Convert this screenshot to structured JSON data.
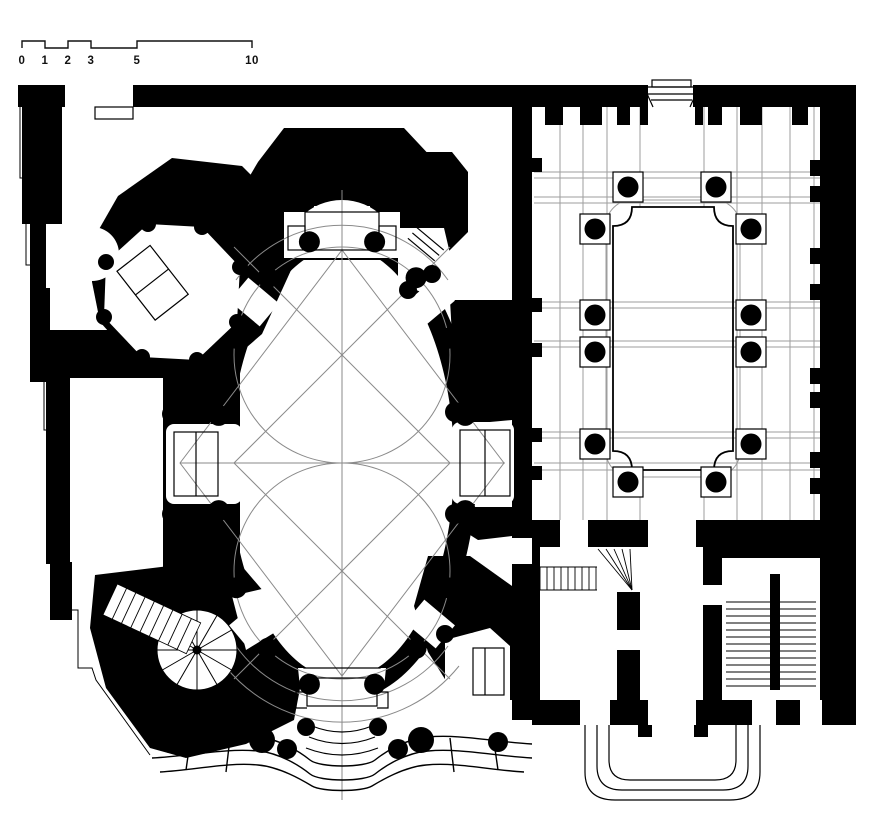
{
  "scale_bar": {
    "labels": [
      "0",
      "1",
      "2",
      "3",
      "5",
      "10"
    ],
    "tick_x": [
      22,
      45,
      68,
      91,
      137,
      252
    ],
    "top_y": 41,
    "base_y": 48,
    "label_y": 64
  },
  "colors": {
    "ink": "#000000",
    "paper": "#ffffff",
    "construction_line": "#8a8a8a",
    "paving_line": "#9d9d9d"
  },
  "church": {
    "center": [
      342,
      463
    ],
    "nave_rx": 112,
    "nave_ry": 216,
    "ring_rx": 135,
    "ring_ry": 238,
    "circle_r": 108,
    "circle_centers": [
      [
        342,
        355
      ],
      [
        342,
        571
      ]
    ],
    "rhombus": [
      [
        180,
        463
      ],
      [
        342,
        250
      ],
      [
        504,
        463
      ],
      [
        342,
        676
      ]
    ],
    "axis_x": 342,
    "column_ring": [
      126,
      229
    ],
    "column_angles_deg": [
      15,
      36,
      57,
      78
    ],
    "column_radius": 10.5,
    "chapel_dots": [
      [
        408,
        290,
        9
      ],
      [
        432,
        274,
        9
      ],
      [
        445,
        634,
        9
      ],
      [
        470,
        624,
        9
      ],
      [
        172,
        414,
        10
      ],
      [
        172,
        514,
        10
      ],
      [
        455,
        412,
        10
      ],
      [
        455,
        514,
        10
      ]
    ]
  },
  "sacristy": {
    "octagon": [
      [
        240,
        267
      ],
      [
        202,
        227
      ],
      [
        148,
        224
      ],
      [
        106,
        262
      ],
      [
        104,
        317
      ],
      [
        142,
        357
      ],
      [
        197,
        360
      ],
      [
        237,
        322
      ]
    ],
    "corner_dot_r": 8
  },
  "facade": {
    "blobs": [
      [
        262,
        740,
        13
      ],
      [
        287,
        749,
        10
      ],
      [
        398,
        749,
        10
      ],
      [
        421,
        740,
        13
      ],
      [
        306,
        727,
        9
      ],
      [
        378,
        727,
        9
      ],
      [
        170,
        744,
        9
      ],
      [
        498,
        742,
        10
      ]
    ]
  },
  "spiral_stair": {
    "cx": 197,
    "cy": 650,
    "r": 40,
    "spokes": 12,
    "hub_r": 4
  },
  "diagonal_stair": {
    "angle": 25,
    "px": 150,
    "py": 618,
    "x": 106,
    "y": 601,
    "w": 92,
    "h": 34,
    "treads": 9
  },
  "cloister": {
    "columns": [
      [
        628,
        187
      ],
      [
        716,
        187
      ],
      [
        595,
        229
      ],
      [
        751,
        229
      ],
      [
        595,
        315
      ],
      [
        751,
        315
      ],
      [
        595,
        352
      ],
      [
        751,
        352
      ],
      [
        595,
        444
      ],
      [
        751,
        444
      ],
      [
        628,
        482
      ],
      [
        716,
        482
      ]
    ],
    "column_radius": 10.5,
    "plinth_size": 30,
    "garden": {
      "x1": 613,
      "y1": 207,
      "x2": 733,
      "y2": 470,
      "bracket": 19
    },
    "grid_vertical_x": [
      560,
      583,
      607,
      640,
      704,
      737,
      762,
      790,
      814
    ],
    "grid_horizontal_y": [
      172,
      178,
      197,
      203,
      302,
      308,
      341,
      347,
      432,
      438,
      463,
      470
    ],
    "grid_x_range": [
      534,
      820
    ],
    "grid_y_range": [
      107,
      520
    ],
    "top_piers": [
      [
        545,
        18
      ],
      [
        580,
        22
      ],
      [
        617,
        13
      ],
      [
        640,
        8
      ],
      [
        695,
        8
      ],
      [
        708,
        14
      ],
      [
        740,
        22
      ],
      [
        792,
        16
      ]
    ],
    "pier_y": 107,
    "pier_h": 18,
    "right_wall_tabs_y": [
      160,
      186,
      248,
      284,
      368,
      392,
      452,
      478
    ],
    "left_wall_stub_y": [
      158,
      298,
      343,
      428,
      466
    ]
  },
  "service_stairs": {
    "flight": {
      "x1": 540,
      "x2": 597,
      "y1": 567,
      "y2": 590,
      "step": 7
    },
    "winder": {
      "pivot": [
        632,
        590
      ],
      "top_y": 549,
      "xs": [
        598,
        606,
        614,
        622,
        630
      ]
    },
    "stairwell": {
      "y1": 602,
      "y2": 690,
      "step": 7,
      "left": [
        726,
        770
      ],
      "right": [
        780,
        816
      ]
    }
  }
}
